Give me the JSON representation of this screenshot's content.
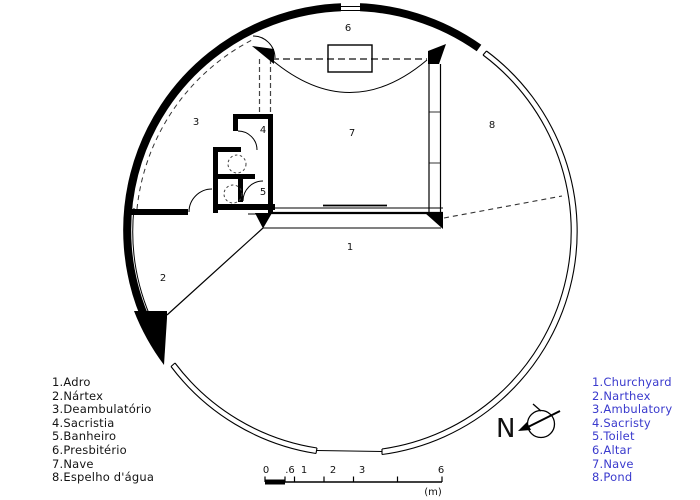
{
  "plan": {
    "room_numbers": [
      "1",
      "2",
      "3",
      "4",
      "5",
      "6",
      "7",
      "8"
    ],
    "north_label": "N"
  },
  "scalebar": {
    "labels": [
      "0",
      ".6",
      "1",
      "2",
      "3",
      "6"
    ],
    "unit": "(m)"
  },
  "legend_pt": {
    "items": [
      "1.Adro",
      "2.Nártex",
      "3.Deambulatório",
      "4.Sacristia",
      "5.Banheiro",
      "6.Presbitério",
      "7.Nave",
      "8.Espelho d'água"
    ]
  },
  "legend_en": {
    "items": [
      "1.Churchyard",
      "2.Narthex",
      "3.Ambulatory",
      "4.Sacristy",
      "5.Toilet",
      "6.Altar",
      "7.Nave",
      "8.Pond"
    ],
    "color": "#3a3acd"
  },
  "colors": {
    "ink": "#000000",
    "background": "#ffffff",
    "legend_en_blue": "#3a3acd"
  }
}
